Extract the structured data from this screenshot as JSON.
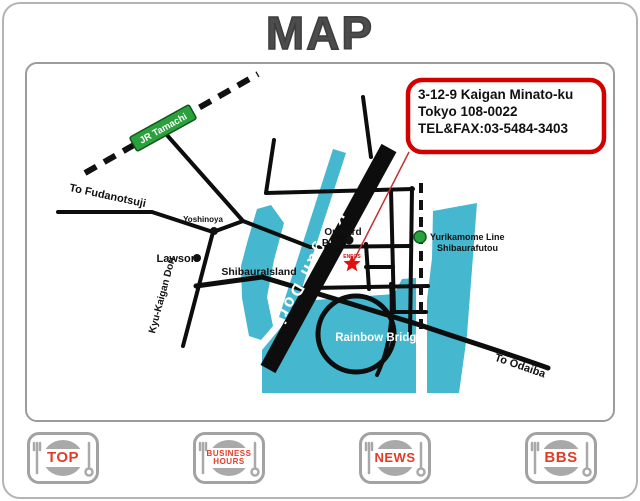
{
  "page": {
    "title": "MAP"
  },
  "map": {
    "address_box": {
      "line1": "3-12-9 Kaigan Minato-ku",
      "line2": "Tokyo 108-0022",
      "line3": "TEL&FAX:03-5484-3403"
    },
    "labels": {
      "jr_station": "JR Tamachi",
      "to_fudanotsuji": "To Fudanotsuji",
      "yoshinoya": "Yoshinoya",
      "lawson": "Lawson",
      "onward": "Onward",
      "pb": "P.B.",
      "eneos": "ENEOS",
      "shibaura_island": "ShibauraIsland",
      "kaigan_dori": "Kaigan Dori",
      "kyu_kaigan_dori": "Kyu-Kaigan Dori",
      "yurikamome_line1": "Yurikamome Line",
      "yurikamome_line2": "Shibaurafutou",
      "rainbow_bridge": "Rainbow Bridge",
      "to_odaiba": "To Odaiba"
    },
    "colors": {
      "water": "#45b7ce",
      "rail_green": "#2aa13c",
      "marker_red": "#e01010",
      "address_border_red": "#d40000",
      "road_black": "#0d0d0d"
    }
  },
  "nav": {
    "buttons": [
      {
        "id": "top",
        "label": "TOP"
      },
      {
        "id": "business-hours",
        "lines": [
          "BUSINESS",
          "HOURS"
        ]
      },
      {
        "id": "news",
        "label": "NEWS"
      },
      {
        "id": "bbs",
        "label": "BBS"
      }
    ]
  }
}
